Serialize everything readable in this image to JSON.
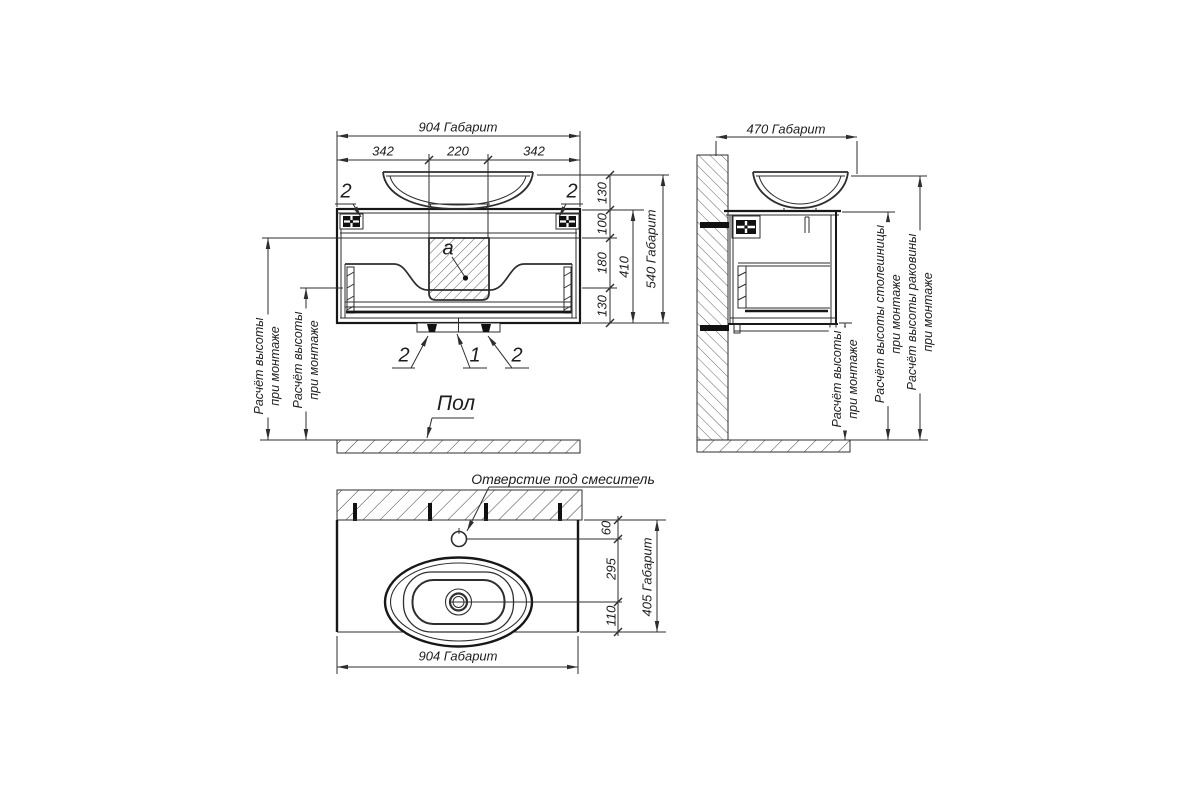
{
  "colors": {
    "line": "#2e2e2e",
    "line_bold": "#171717",
    "text": "#1d1d1d",
    "background": "#ffffff"
  },
  "front_view": {
    "dim_width_total": "904 Габарит",
    "dim_width_left": "342",
    "dim_width_center": "220",
    "dim_width_right": "342",
    "dim_sink_height": "130",
    "dim_top_section": "100",
    "dim_middle_section": "180",
    "dim_bottom_section": "130",
    "dim_cabinet_height": "410",
    "dim_height_total": "540 Габарит",
    "callout_clip_left": "2",
    "callout_clip_right": "2",
    "callout_siphon_area": "a",
    "callout_foot_left": "2",
    "callout_base_center": "1",
    "callout_foot_right": "2",
    "mount_height_note_line1": "Расчёт высоты",
    "mount_height_note_line2": "при монтаже",
    "floor_label": "Пол"
  },
  "side_view": {
    "dim_depth_total": "470 Габарит",
    "mount_height_note_line1": "Расчёт высоты",
    "mount_height_note_line2": "при монтаже",
    "countertop_height_note_line1": "Расчёт высоты столешницы",
    "countertop_height_note_line2": "при монтаже",
    "sink_height_note_line1": "Расчёт высоты раковины",
    "sink_height_note_line2": "при монтаже"
  },
  "top_view": {
    "faucet_hole_label": "Отверстие под смеситель",
    "dim_faucet_offset": "60",
    "dim_drain_offset": "295",
    "dim_front_offset": "110",
    "dim_depth_total": "405 Габарит",
    "dim_width_total": "904 Габарит"
  }
}
